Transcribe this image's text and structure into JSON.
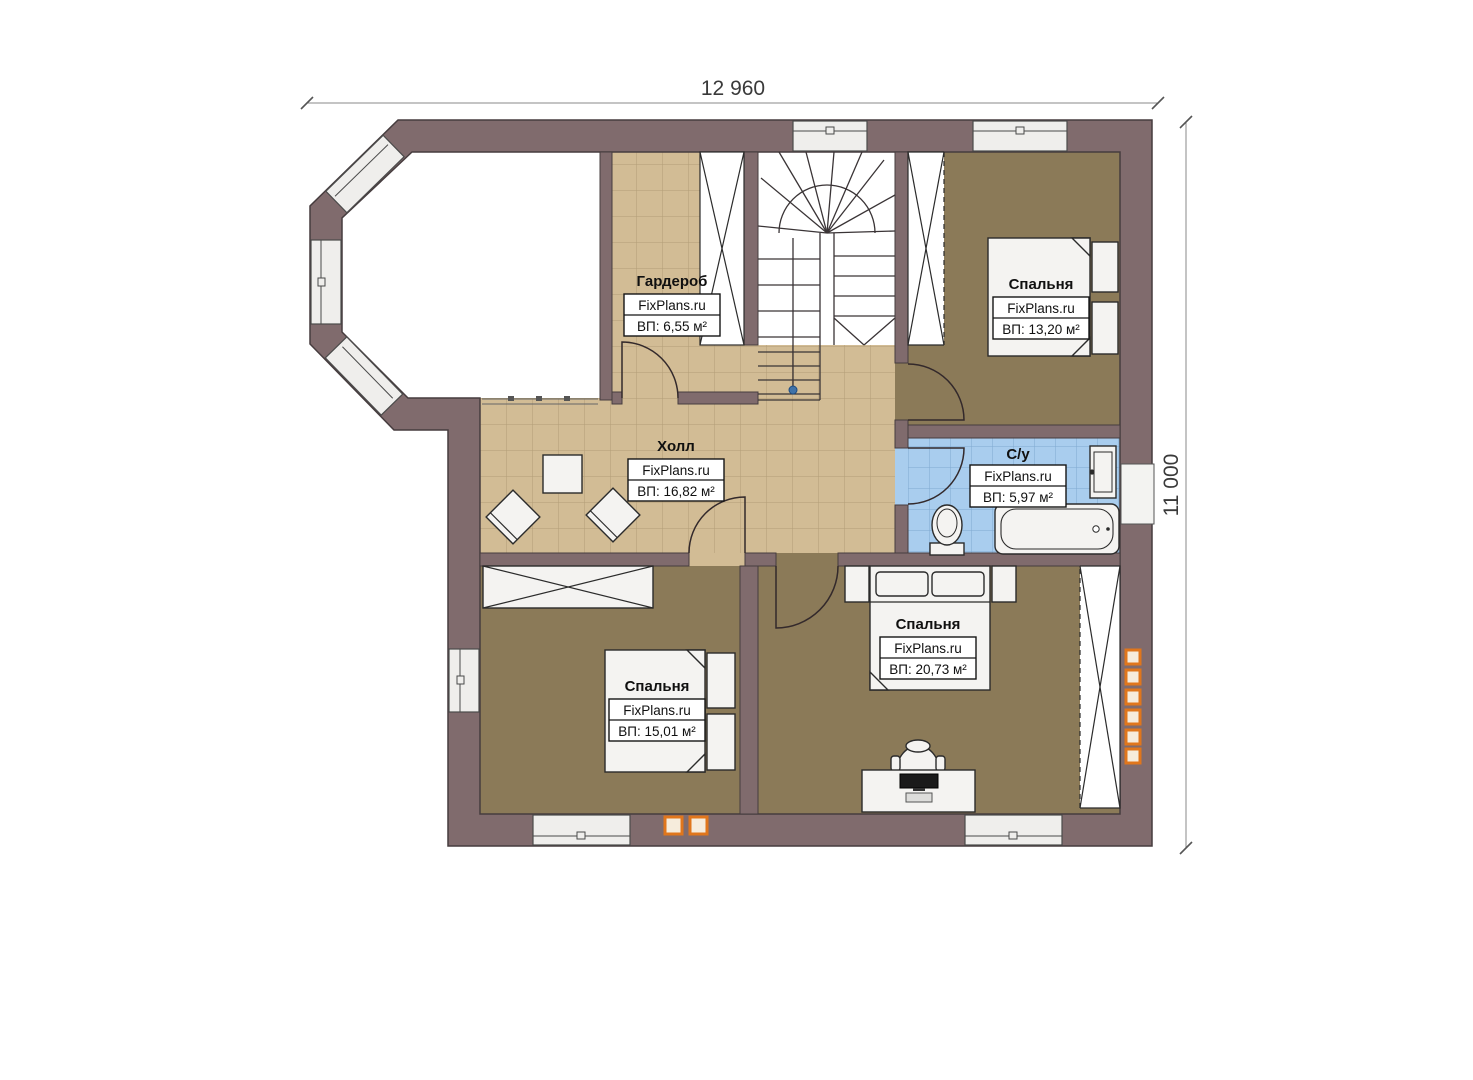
{
  "plan": {
    "brand": "FixPlans.ru",
    "dimensions": {
      "width_label": "12 960",
      "height_label": "11 000"
    },
    "rooms": [
      {
        "id": "wardrobe",
        "name": "Гардероб",
        "area": "ВП: 6,55 м²"
      },
      {
        "id": "bedroom-top",
        "name": "Спальня",
        "area": "ВП: 13,20 м²"
      },
      {
        "id": "hall",
        "name": "Холл",
        "area": "ВП: 16,82 м²"
      },
      {
        "id": "bathroom",
        "name": "С/у",
        "area": "ВП: 5,97 м²"
      },
      {
        "id": "bedroom-right",
        "name": "Спальня",
        "area": "ВП: 20,73 м²"
      },
      {
        "id": "bedroom-left",
        "name": "Спальня",
        "area": "ВП: 15,01 м²"
      }
    ],
    "colors": {
      "wall": "#806b6d",
      "wall_edge": "#463c3e",
      "carpet": "#8b7a58",
      "tile": "#d2bc95",
      "tile_line": "#b29d77",
      "bath_tile": "#a9cdee",
      "bath_tile_line": "#7fa9d0",
      "vent_orange": "#e0761c",
      "stair_marker_blue": "#3f72a8"
    }
  }
}
